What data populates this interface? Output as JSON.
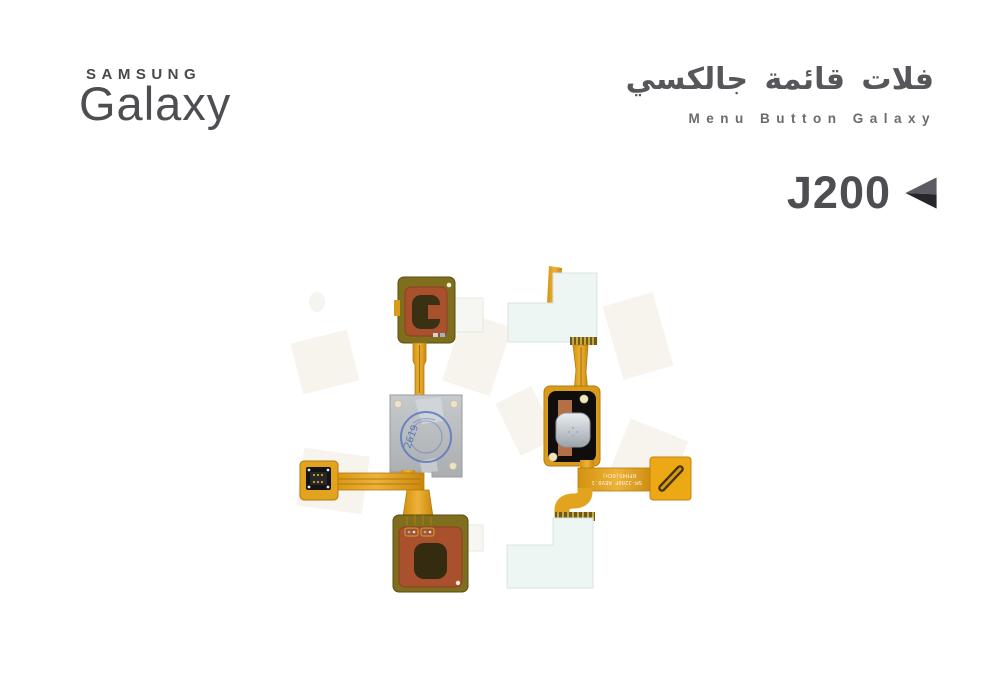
{
  "page": {
    "background": "#ffffff"
  },
  "brand": {
    "samsung_wordmark": "SAMSUNG",
    "galaxy_wordmark": "Galaxy",
    "color": "#4d4d52"
  },
  "title": {
    "arabic": "فلات قائمة جالكسي",
    "english": "Menu Button Galaxy",
    "arabic_color": "#57575b",
    "english_color": "#6b6b6f"
  },
  "model": {
    "label": "J200",
    "color": "#4d4d52",
    "icon": "back-triangle-icon",
    "icon_colors": {
      "light": "#5c5c65",
      "dark": "#26262b"
    }
  },
  "photos": {
    "left_flex": {
      "description": "menu button flex cable, back side",
      "stamp_text": "2619",
      "colors": {
        "kapton_gold": "#e2a41f",
        "pad_olive": "#7f6e1e",
        "sticker_red": "#a8512c",
        "mesh_dark": "#3a3115",
        "plate_gray": "#b7bbbd",
        "stamp_blue": "#5a79c0",
        "connector_black": "#161616"
      }
    },
    "right_flex": {
      "description": "menu button flex cable, front side",
      "ribbon_text_line1": "SM-J200F REV0.1",
      "ribbon_text_line2": "RFH4S(0Ch)",
      "colors": {
        "kapton_gold": "#e2a41f",
        "button_pad_black": "#0f0e0c",
        "dome_silver": "#c9ced4",
        "copper": "#b46f47",
        "sticker_white": "#edf6f3",
        "connector_tab_orange": "#eda816"
      }
    }
  }
}
